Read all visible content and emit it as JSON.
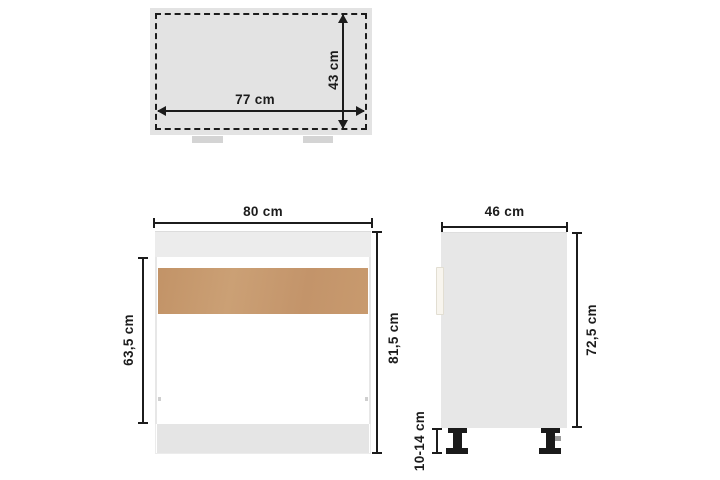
{
  "colors": {
    "background": "#ffffff",
    "line": "#1c1c1c",
    "panel": "#e3e3e3",
    "panel_light": "#ececec",
    "plinth": "#e5e5e5",
    "side_panel": "#e7e7e7",
    "wood": "#c79b6d",
    "leg": "#1a1a1a",
    "tab": "#d4d4d4"
  },
  "views": {
    "top_view": {
      "width_label": "77 cm",
      "depth_label": "43 cm"
    },
    "front_view": {
      "width_label": "80 cm",
      "carcass_height_label": "63,5 cm",
      "total_height_label": "81,5 cm"
    },
    "side_view": {
      "depth_label": "46 cm",
      "body_height_label": "72,5 cm",
      "leg_height_label": "10-14 cm"
    }
  }
}
